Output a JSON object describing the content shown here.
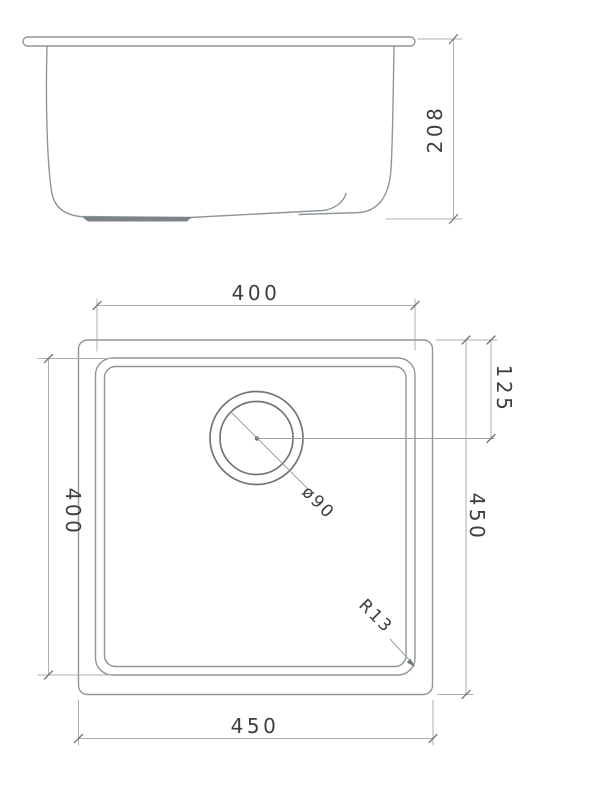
{
  "colors": {
    "background": "#ffffff",
    "outline": "#8f969b",
    "drain_outline": "#6f7679",
    "dimension_line": "#aab0b3",
    "text": "#3a3f42",
    "pad_fill": "#7d8488"
  },
  "side_view": {
    "height": "208"
  },
  "top_view": {
    "bowl_width": "400",
    "bowl_length": "400",
    "overall_length": "450",
    "overall_width": "450",
    "drain_offset": "125",
    "drain_diameter": "ø90",
    "corner_radius": "R13"
  }
}
